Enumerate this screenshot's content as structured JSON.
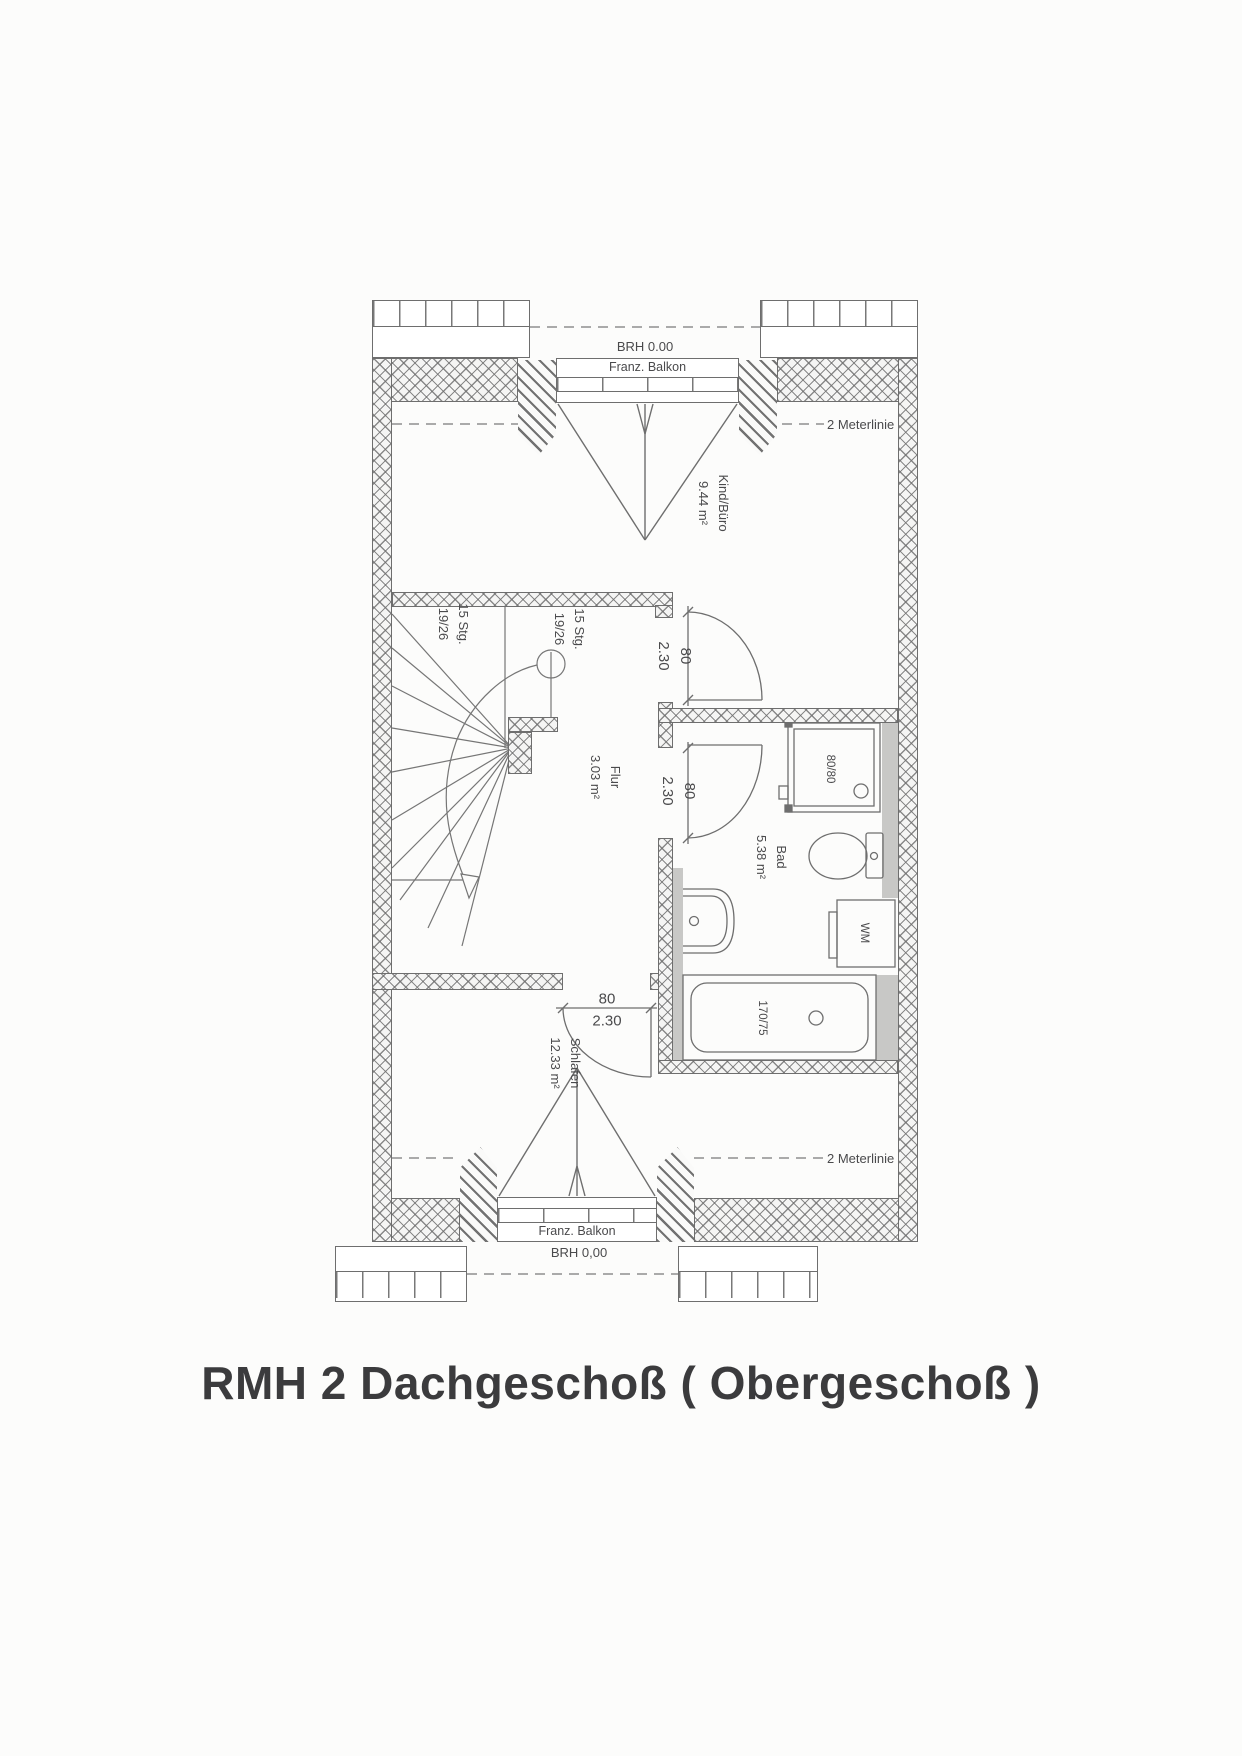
{
  "title": "RMH 2 Dachgeschoß ( Obergeschoß )",
  "colors": {
    "line": "#6e6e6e",
    "duct": "#c8c8c6",
    "text": "#4a4a4c",
    "title": "#3b3b3d",
    "dash": "#8f8f8f"
  },
  "top": {
    "brh": "BRH 0.00",
    "balkon": "Franz. Balkon",
    "meterlinie": "2 Meterlinie"
  },
  "bottom": {
    "brh": "BRH 0,00",
    "balkon": "Franz. Balkon",
    "meterlinie": "2 Meterlinie"
  },
  "rooms": {
    "kind": {
      "name": "Kind/Büro",
      "area": "9.44 m²"
    },
    "flur": {
      "name": "Flur",
      "area": "3.03 m²"
    },
    "bad": {
      "name": "Bad",
      "area": "5.38 m²"
    },
    "schlafen": {
      "name": "Schlafen",
      "area": "12.33 m²"
    }
  },
  "stairs": {
    "label_left": {
      "line1": "15 Stg.",
      "line2": "19/26"
    },
    "label_right": {
      "line1": "15 Stg.",
      "line2": "19/26"
    }
  },
  "doors": {
    "kind": {
      "width": "80",
      "height": "2.30"
    },
    "bad": {
      "width": "80",
      "height": "2.30"
    },
    "schlafen": {
      "width": "80",
      "height": "2.30"
    }
  },
  "fixtures": {
    "shower": "80/80",
    "washer": "WM",
    "bathtub": "170/75"
  }
}
